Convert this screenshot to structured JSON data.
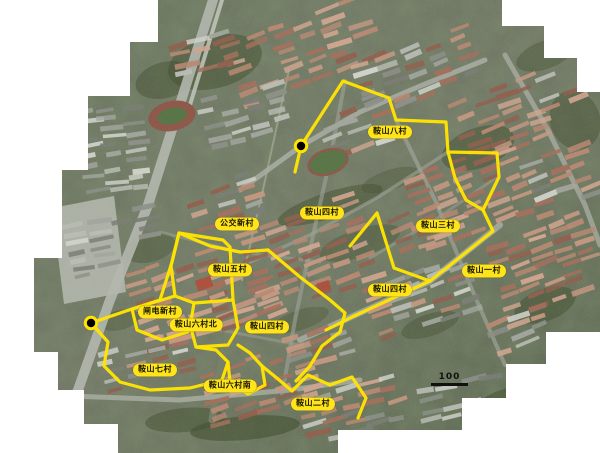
{
  "map": {
    "kind": "satellite-mosaic-with-district-annotations",
    "labels": [
      {
        "text": "鞍山八村",
        "x": 390,
        "y": 132
      },
      {
        "text": "公交新村",
        "x": 237,
        "y": 224
      },
      {
        "text": "鞍山四村",
        "x": 322,
        "y": 213
      },
      {
        "text": "鞍山三村",
        "x": 438,
        "y": 226
      },
      {
        "text": "鞍山五村",
        "x": 230,
        "y": 270
      },
      {
        "text": "鞍山一村",
        "x": 484,
        "y": 271
      },
      {
        "text": "鞍山四村",
        "x": 390,
        "y": 290
      },
      {
        "text": "闸电新村",
        "x": 160,
        "y": 312
      },
      {
        "text": "鞍山六村北",
        "x": 196,
        "y": 325
      },
      {
        "text": "鞍山四村",
        "x": 267,
        "y": 327
      },
      {
        "text": "鞍山七村",
        "x": 155,
        "y": 370
      },
      {
        "text": "鞍山六村南",
        "x": 230,
        "y": 386
      },
      {
        "text": "鞍山二村",
        "x": 313,
        "y": 404
      }
    ],
    "markers": [
      {
        "x": 301,
        "y": 146
      },
      {
        "x": 91,
        "y": 323
      }
    ],
    "scale_bar": {
      "label": "100",
      "bar_x": 431,
      "bar_y": 384,
      "bar_w": 37,
      "text_y": 372
    },
    "boundaries": [
      "295,172 301,146 343,81 389,98 396,120 446,122 448,152 497,153 499,177 483,210 493,231 430,281 352,317 326,330",
      "448,152 455,178 466,200 483,210",
      "350,246 377,213 394,268 430,281",
      "268,250 300,277 330,300 345,313 340,332 322,346 310,366 296,381",
      "179,233 210,246 240,252 268,250",
      "91,323 132,309 160,300 172,262 179,233",
      "179,233 223,240 230,247 233,300 194,303 175,296 171,266 179,233",
      "175,296 132,309 137,330 162,340 188,332 192,315 194,303",
      "233,300 238,328 228,345 196,347 192,332",
      "91,323 108,342 104,366 120,382 150,390 190,388 222,380 228,362 216,350 196,347",
      "238,345 250,353 262,366 265,385 248,394 230,382 228,362",
      "262,366 278,379 292,391 308,375 330,385 352,377 366,398 358,418"
    ],
    "colors": {
      "boundary": "#ffe400",
      "label_bg": "#ffe41a",
      "label_text": "#141400",
      "marker_dot": "#000000",
      "marker_ring": "#ffe400",
      "scale": "#111111",
      "background": "#ffffff"
    }
  }
}
